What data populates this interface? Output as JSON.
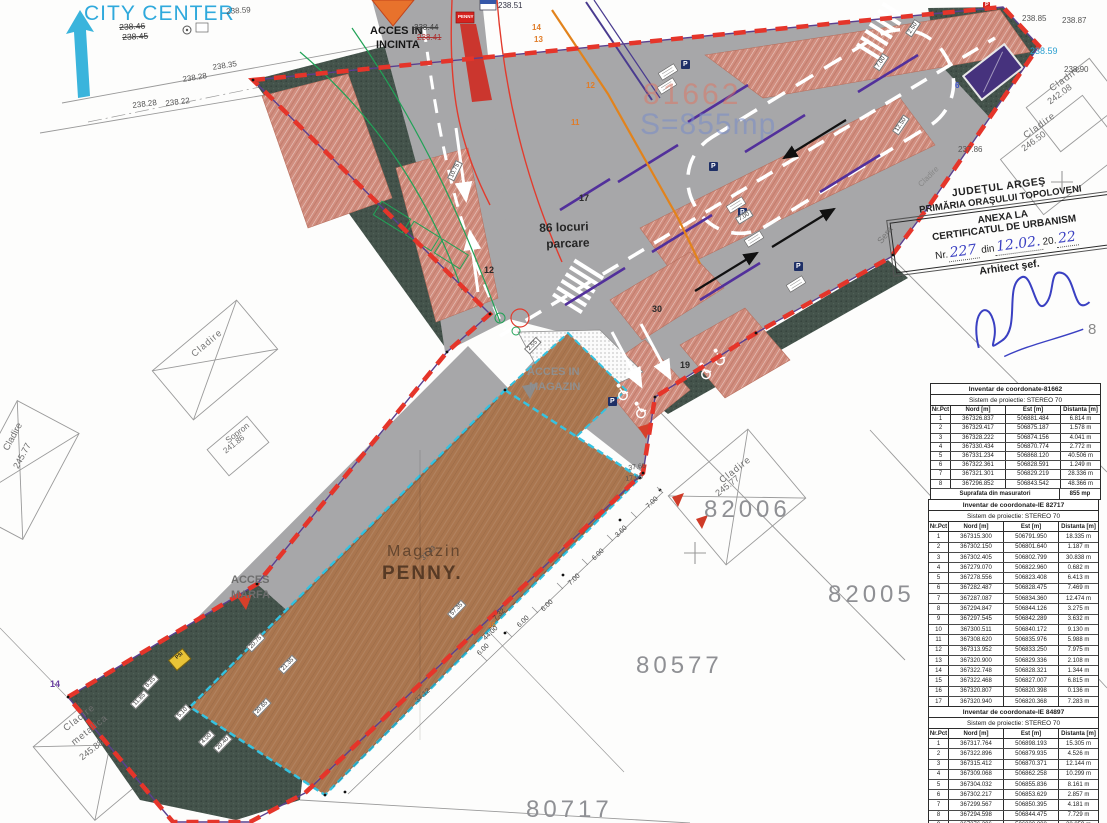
{
  "stamp": {
    "line1": "JUDEŢUL ARGEŞ",
    "line2": "PRIMĂRIA ORAŞULUI TOPOLOVENI",
    "line3": "ANEXA LA",
    "line4": "CERTIFICATUL DE URBANISM",
    "nr_label": "Nr.",
    "nr_value": "227",
    "din_label": "din",
    "date_value": "12.02.",
    "year_prefix": "20.",
    "year_value": "22",
    "line6": "Arhitect şef."
  },
  "tables": [
    {
      "title": "Inventar de coordonate-81662",
      "system": "Sistem de proiectie: STEREO 70",
      "columns": [
        "Nr.Pct",
        "Nord [m]",
        "Est [m]",
        "Distanta [m]"
      ],
      "row_h": 8.2,
      "rows": [
        [
          "1",
          "367326.837",
          "506881.484",
          "6.814 m"
        ],
        [
          "2",
          "367329.417",
          "506875.187",
          "1.578 m"
        ],
        [
          "3",
          "367328.222",
          "506874.156",
          "4.041 m"
        ],
        [
          "4",
          "367330.434",
          "506870.774",
          "2.772 m"
        ],
        [
          "5",
          "367331.234",
          "506868.120",
          "40.506 m"
        ],
        [
          "6",
          "367322.361",
          "506828.591",
          "1.249 m"
        ],
        [
          "7",
          "367321.301",
          "506829.219",
          "28.336 m"
        ],
        [
          "8",
          "367296.852",
          "506843.542",
          "48.366 m"
        ]
      ],
      "footer": [
        "Suprafata din masuratori",
        "855 mp"
      ]
    },
    {
      "title": "Inventar de coordonate-IE 82717",
      "system": "Sistem de proiectie: STEREO 70",
      "columns": [
        "Nr.Pct",
        "Nord [m]",
        "Est [m]",
        "Distanta [m]"
      ],
      "row_h": 9.3,
      "rows": [
        [
          "1",
          "367315.300",
          "506791.950",
          "18.335 m"
        ],
        [
          "2",
          "367302.150",
          "506801.640",
          "1.187 m"
        ],
        [
          "3",
          "367302.405",
          "506802.799",
          "30.838 m"
        ],
        [
          "4",
          "367279.070",
          "506822.960",
          "0.682 m"
        ],
        [
          "5",
          "367278.556",
          "506823.408",
          "6.413 m"
        ],
        [
          "6",
          "367282.487",
          "506828.475",
          "7.469 m"
        ],
        [
          "7",
          "367287.087",
          "506834.360",
          "12.474 m"
        ],
        [
          "8",
          "367294.847",
          "506844.126",
          "3.275 m"
        ],
        [
          "9",
          "367297.545",
          "506842.289",
          "3.632 m"
        ],
        [
          "10",
          "367300.511",
          "506840.172",
          "9.130 m"
        ],
        [
          "11",
          "367308.620",
          "506835.976",
          "5.988 m"
        ],
        [
          "12",
          "367313.952",
          "506833.250",
          "7.975 m"
        ],
        [
          "13",
          "367320.900",
          "506829.336",
          "2.108 m"
        ],
        [
          "14",
          "367322.748",
          "506828.321",
          "1.344 m"
        ],
        [
          "15",
          "367322.468",
          "506827.007",
          "6.815 m"
        ],
        [
          "16",
          "367320.807",
          "506820.398",
          "0.136 m"
        ],
        [
          "17",
          "367320.940",
          "506820.368",
          "7.283 m"
        ],
        [
          "18",
          "367319.542",
          "506813.220",
          "21.689 m"
        ]
      ],
      "footer": [
        "Suprafata din masuratori",
        "1205 mp"
      ]
    },
    {
      "title": "Inventar de coordonate-IE 84897",
      "system": "Sistem de proiectie: STEREO 70",
      "columns": [
        "Nr.Pct",
        "Nord [m]",
        "Est [m]",
        "Distanta [m]"
      ],
      "row_h": 9.2,
      "rows": [
        [
          "1",
          "367317.764",
          "506898.193",
          "15.305 m"
        ],
        [
          "2",
          "367322.896",
          "506879.935",
          "4.526 m"
        ],
        [
          "3",
          "367315.412",
          "506870.371",
          "12.144 m"
        ],
        [
          "4",
          "367309.068",
          "506862.258",
          "10.299 m"
        ],
        [
          "5",
          "367304.032",
          "506855.836",
          "8.161 m"
        ],
        [
          "6",
          "367302.217",
          "506853.629",
          "2.857 m"
        ],
        [
          "7",
          "367299.567",
          "506850.395",
          "4.181 m"
        ],
        [
          "8",
          "367294.598",
          "506844.475",
          "7.729 m"
        ],
        [
          "9",
          "367276.396",
          "506820.808",
          "28.859 m"
        ],
        [
          "10",
          "367260.303",
          "506801.685",
          "24.992 m"
        ]
      ],
      "footer": null
    }
  ],
  "floating_labels": [
    {
      "n": "city-center-label",
      "t": "CITY CENTER",
      "x": 84,
      "y": 3,
      "fs": 21,
      "c": "#2fa9dc",
      "ls": 1
    },
    {
      "n": "elev-238-59-top",
      "t": "238.59",
      "x": 226,
      "y": 8,
      "fs": 8,
      "c": "#555",
      "r": -4
    },
    {
      "n": "elev-238-46",
      "t": "238.46",
      "x": 119,
      "y": 23,
      "fs": 8.5,
      "c": "#3a3a3a",
      "r": -3,
      "strike": 1
    },
    {
      "n": "elev-238-45",
      "t": "238.45",
      "x": 122,
      "y": 33,
      "fs": 8.5,
      "c": "#3a3a3a",
      "r": -3,
      "strike": 1
    },
    {
      "n": "elev-238-35",
      "t": "238.35",
      "x": 212,
      "y": 64,
      "fs": 8,
      "c": "#555",
      "r": -9
    },
    {
      "n": "elev-238-28",
      "t": "238.28",
      "x": 182,
      "y": 76,
      "fs": 8,
      "c": "#555",
      "r": -9
    },
    {
      "n": "elev-238-28b",
      "t": "238.28",
      "x": 132,
      "y": 102,
      "fs": 8,
      "c": "#555",
      "r": -7
    },
    {
      "n": "elev-238-22",
      "t": "238.22",
      "x": 165,
      "y": 100,
      "fs": 8,
      "c": "#555",
      "r": -7
    },
    {
      "n": "acces-incinta-line1",
      "t": "ACCES IN",
      "x": 370,
      "y": 26,
      "fs": 11,
      "c": "#161616",
      "b": 1
    },
    {
      "n": "acces-incinta-line2",
      "t": "INCINTA",
      "x": 376,
      "y": 40,
      "fs": 11,
      "c": "#161616",
      "b": 1
    },
    {
      "n": "elev-238-44",
      "t": "238.44",
      "x": 414,
      "y": 24,
      "fs": 8,
      "c": "#444",
      "strike": 1
    },
    {
      "n": "elev-238-41",
      "t": "238.41",
      "x": 417,
      "y": 34,
      "fs": 8,
      "c": "#a33",
      "strike": 1
    },
    {
      "n": "elev-238-51",
      "t": "238.51",
      "x": 498,
      "y": 2,
      "fs": 8,
      "c": "#334"
    },
    {
      "n": "penny-totem-label",
      "t": "PENNY",
      "x": 458,
      "y": 15,
      "fs": 4.5,
      "c": "#fff",
      "b": 1
    },
    {
      "n": "pt-14",
      "t": "14",
      "x": 532,
      "y": 24,
      "fs": 8,
      "c": "#e07c28",
      "b": 1
    },
    {
      "n": "pt-13",
      "t": "13",
      "x": 534,
      "y": 36,
      "fs": 8,
      "c": "#e07c28",
      "b": 1
    },
    {
      "n": "pt-12",
      "t": "12",
      "x": 586,
      "y": 82,
      "fs": 8,
      "c": "#e07c28",
      "b": 1
    },
    {
      "n": "pt-11",
      "t": "11",
      "x": 571,
      "y": 119,
      "fs": 8,
      "c": "#e07c28",
      "b": 1
    },
    {
      "n": "pt-17",
      "t": "17",
      "x": 579,
      "y": 194,
      "fs": 9,
      "c": "#2b2b2b",
      "b": 1
    },
    {
      "n": "pt-12b",
      "t": "12",
      "x": 484,
      "y": 266,
      "fs": 9,
      "c": "#2b2b2b",
      "b": 1
    },
    {
      "n": "pt-30",
      "t": "30",
      "x": 652,
      "y": 305,
      "fs": 9,
      "c": "#2b2b2b",
      "b": 1
    },
    {
      "n": "pt-19",
      "t": "19",
      "x": 680,
      "y": 361,
      "fs": 9,
      "c": "#2b2b2b",
      "b": 1
    },
    {
      "n": "pt-16",
      "t": "16",
      "x": 488,
      "y": 622,
      "fs": 7,
      "c": "#e07c28",
      "b": 1
    },
    {
      "n": "pt-14-purple",
      "t": "14",
      "x": 50,
      "y": 680,
      "fs": 9,
      "c": "#6a3fa0",
      "b": 1
    },
    {
      "n": "pt-6-blue",
      "t": "6",
      "x": 955,
      "y": 82,
      "fs": 8,
      "c": "#3b52c8",
      "b": 1
    },
    {
      "n": "parcare-line1",
      "t": "86 locuri",
      "x": 539,
      "y": 222,
      "fs": 12,
      "c": "#262626",
      "b": 1,
      "r": -2
    },
    {
      "n": "parcare-line2",
      "t": "parcare",
      "x": 546,
      "y": 238,
      "fs": 12,
      "c": "#262626",
      "b": 1,
      "r": -2
    },
    {
      "n": "overlay-81662",
      "t": "81662",
      "x": 643,
      "y": 80,
      "fs": 30,
      "c": "rgba(225,115,95,0.5)",
      "ls": 3
    },
    {
      "n": "overlay-s855mp",
      "t": "S=855mp",
      "x": 640,
      "y": 110,
      "fs": 30,
      "c": "rgba(120,140,200,0.55)",
      "ls": 1
    },
    {
      "n": "acces-magazin-line1",
      "t": "ACCES IN",
      "x": 527,
      "y": 367,
      "fs": 11,
      "c": "#8f8f8f",
      "b": 1
    },
    {
      "n": "acces-magazin-line2",
      "t": "MAGAZIN",
      "x": 529,
      "y": 382,
      "fs": 11,
      "c": "#8f8f8f",
      "b": 1
    },
    {
      "n": "acces-marfa-line1",
      "t": "ACCES",
      "x": 231,
      "y": 575,
      "fs": 11,
      "c": "#6e6e6e",
      "b": 1
    },
    {
      "n": "acces-marfa-line2",
      "t": "MARFA",
      "x": 231,
      "y": 590,
      "fs": 11,
      "c": "#6e6e6e",
      "b": 1
    },
    {
      "n": "magazin-label",
      "t": "Magazin",
      "x": 387,
      "y": 544,
      "fs": 16,
      "c": "#64462f",
      "ls": 2
    },
    {
      "n": "penny-label",
      "t": "PENNY.",
      "x": 382,
      "y": 564,
      "fs": 19,
      "c": "#573a25",
      "b": 1,
      "ls": 2
    },
    {
      "n": "psi-label",
      "t": "PSI",
      "x": 175,
      "y": 657,
      "fs": 5,
      "c": "#222",
      "b": 1,
      "r": -40
    },
    {
      "n": "parcel-82006",
      "t": "82006",
      "x": 704,
      "y": 498,
      "fs": 24,
      "c": "#8f9094",
      "ls": 4
    },
    {
      "n": "parcel-82005",
      "t": "82005",
      "x": 828,
      "y": 583,
      "fs": 24,
      "c": "#8f9094",
      "ls": 4
    },
    {
      "n": "parcel-80577",
      "t": "80577",
      "x": 636,
      "y": 654,
      "fs": 24,
      "c": "#8f9094",
      "ls": 4
    },
    {
      "n": "parcel-80717",
      "t": "80717",
      "x": 526,
      "y": 798,
      "fs": 24,
      "c": "#8f9094",
      "ls": 4
    },
    {
      "n": "cladire-ne1-name",
      "t": "Cladire",
      "x": 1048,
      "y": 86,
      "fs": 9.5,
      "c": "#6f6f6f",
      "r": -36,
      "ls": 1
    },
    {
      "n": "cladire-ne1-elev",
      "t": "242.08",
      "x": 1046,
      "y": 99,
      "fs": 9,
      "c": "#6f6f6f",
      "r": -36
    },
    {
      "n": "cladire-ne2-name",
      "t": "Cladire",
      "x": 1022,
      "y": 133,
      "fs": 9.5,
      "c": "#6f6f6f",
      "r": -36,
      "ls": 1
    },
    {
      "n": "cladire-ne2-elev",
      "t": "246.50",
      "x": 1020,
      "y": 146,
      "fs": 9,
      "c": "#6f6f6f",
      "r": -36
    },
    {
      "n": "elev-238-85",
      "t": "238.85",
      "x": 1022,
      "y": 15,
      "fs": 8,
      "c": "#555"
    },
    {
      "n": "elev-238-87",
      "t": "238.87",
      "x": 1062,
      "y": 17,
      "fs": 8,
      "c": "#555"
    },
    {
      "n": "elev-238-59-right",
      "t": "238.59",
      "x": 1030,
      "y": 47,
      "fs": 9,
      "c": "#2a9fd0"
    },
    {
      "n": "elev-238-90",
      "t": "238.90",
      "x": 1064,
      "y": 66,
      "fs": 8,
      "c": "#555"
    },
    {
      "n": "elev-237-86",
      "t": "237.86",
      "x": 958,
      "y": 146,
      "fs": 8,
      "c": "#555"
    },
    {
      "n": "cladire-82006-name",
      "t": "Cladire",
      "x": 718,
      "y": 478,
      "fs": 9.5,
      "c": "#6f6f6f",
      "r": -38,
      "ls": 1
    },
    {
      "n": "cladire-82006-elev",
      "t": "245.77",
      "x": 714,
      "y": 491,
      "fs": 9,
      "c": "#6f6f6f",
      "r": -38
    },
    {
      "n": "sopron-name",
      "t": "Sopron",
      "x": 224,
      "y": 438,
      "fs": 8.5,
      "c": "#6f6f6f",
      "r": -38
    },
    {
      "n": "sopron-elev",
      "t": "241.86",
      "x": 222,
      "y": 449,
      "fs": 8,
      "c": "#6f6f6f",
      "r": -38
    },
    {
      "n": "cladire-left-name",
      "t": "Cladire",
      "x": 2,
      "y": 448,
      "fs": 9.5,
      "c": "#6f6f6f",
      "r": -62
    },
    {
      "n": "cladire-left-elev",
      "t": "245.77",
      "x": 12,
      "y": 466,
      "fs": 9,
      "c": "#6f6f6f",
      "r": -62
    },
    {
      "n": "cladire-west-name",
      "t": "Cladire",
      "x": 190,
      "y": 352,
      "fs": 9.5,
      "c": "#777777",
      "r": -40,
      "ls": 1
    },
    {
      "n": "cladire-metalica-1",
      "t": "Cladire",
      "x": 62,
      "y": 726,
      "fs": 9.5,
      "c": "#6f6f6f",
      "r": -38,
      "ls": 1
    },
    {
      "n": "cladire-metalica-2",
      "t": "metalica",
      "x": 70,
      "y": 740,
      "fs": 9.5,
      "c": "#6f6f6f",
      "r": -38,
      "ls": 1
    },
    {
      "n": "cladire-metalica-3",
      "t": "245.88",
      "x": 78,
      "y": 755,
      "fs": 9,
      "c": "#6f6f6f",
      "r": -38
    },
    {
      "n": "sera-label",
      "t": "Sera",
      "x": 876,
      "y": 240,
      "fs": 9,
      "c": "#777777",
      "r": -52
    },
    {
      "n": "cladire-stamp",
      "t": "Cladire",
      "x": 917,
      "y": 183,
      "fs": 8,
      "c": "#888888",
      "r": -45
    },
    {
      "n": "big-8",
      "t": "8",
      "x": 1088,
      "y": 322,
      "fs": 15,
      "c": "#8a8a8a"
    },
    {
      "n": "p-sign-label-1",
      "t": "P",
      "x": 683,
      "y": 61,
      "fs": 7,
      "c": "#fff",
      "b": 1
    },
    {
      "n": "p-sign-label-2",
      "t": "P",
      "x": 711,
      "y": 163,
      "fs": 7,
      "c": "#fff",
      "b": 1
    },
    {
      "n": "p-sign-label-3",
      "t": "P",
      "x": 740,
      "y": 209,
      "fs": 7,
      "c": "#fff",
      "b": 1
    },
    {
      "n": "p-sign-label-4",
      "t": "P",
      "x": 796,
      "y": 263,
      "fs": 7,
      "c": "#fff",
      "b": 1
    },
    {
      "n": "p-sign-label-5",
      "t": "P",
      "x": 610,
      "y": 398,
      "fs": 7,
      "c": "#fff",
      "b": 1
    },
    {
      "n": "p-sign-label-6",
      "t": "P",
      "x": 985,
      "y": 3,
      "fs": 5.5,
      "c": "#fff",
      "b": 1
    },
    {
      "n": "dim-10-75",
      "t": "10.75",
      "x": 447,
      "y": 178,
      "fs": 6,
      "r": -64,
      "w": 1
    },
    {
      "n": "dim-2-50",
      "t": "2.50",
      "x": 905,
      "y": 33,
      "fs": 6,
      "r": -56,
      "w": 1
    },
    {
      "n": "dim-7-00a",
      "t": "7.00",
      "x": 873,
      "y": 67,
      "fs": 6,
      "r": -56,
      "w": 1
    },
    {
      "n": "dim-12-50",
      "t": "12.50",
      "x": 892,
      "y": 131,
      "fs": 6,
      "r": -56,
      "w": 1
    },
    {
      "n": "dim-7-00b",
      "t": "7.00",
      "x": 735,
      "y": 218,
      "fs": 6,
      "r": -32,
      "w": 1
    },
    {
      "n": "dim-2-55",
      "t": "2.55",
      "x": 524,
      "y": 349,
      "fs": 6,
      "r": -46,
      "w": 1
    },
    {
      "n": "dim-20-75",
      "t": "20.75",
      "x": 246,
      "y": 647,
      "fs": 6,
      "r": -46,
      "w": 1
    },
    {
      "n": "dim-8-35",
      "t": "8.35",
      "x": 142,
      "y": 686,
      "fs": 6,
      "r": -46,
      "w": 1
    },
    {
      "n": "dim-11-85",
      "t": "11.85",
      "x": 130,
      "y": 704,
      "fs": 6,
      "r": -46,
      "w": 1
    },
    {
      "n": "dim-5-10",
      "t": "5.10",
      "x": 174,
      "y": 716,
      "fs": 6,
      "r": -46,
      "w": 1
    },
    {
      "n": "dim-4-00",
      "t": "4.00",
      "x": 198,
      "y": 742,
      "fs": 6,
      "r": -46,
      "w": 1
    },
    {
      "n": "dim-20-40",
      "t": "20.40",
      "x": 213,
      "y": 748,
      "fs": 6,
      "r": -46,
      "w": 1
    },
    {
      "n": "dim-20-65",
      "t": "20.65",
      "x": 252,
      "y": 712,
      "fs": 6,
      "r": -46,
      "w": 1
    },
    {
      "n": "dim-21-35",
      "t": "21.35",
      "x": 278,
      "y": 669,
      "fs": 6,
      "r": -46,
      "w": 1
    },
    {
      "n": "dim-57-35",
      "t": "57.35",
      "x": 447,
      "y": 614,
      "fs": 6,
      "r": -46,
      "w": 1
    },
    {
      "n": "dim-37-43",
      "t": "37.43",
      "x": 420,
      "y": 557,
      "fs": 7,
      "c": "#555",
      "r": -44
    },
    {
      "n": "dim-37-12",
      "t": "37.12",
      "x": 414,
      "y": 699,
      "fs": 7,
      "c": "#555",
      "r": -42
    },
    {
      "n": "dim-37-66",
      "t": "37.66",
      "x": 628,
      "y": 465,
      "fs": 7,
      "c": "#555",
      "r": -8
    },
    {
      "n": "dim-17-66",
      "t": "17.66",
      "x": 625,
      "y": 476,
      "fs": 7,
      "c": "#555",
      "r": -8
    },
    {
      "n": "dim-7-00c",
      "t": "7.00",
      "x": 645,
      "y": 505,
      "fs": 7,
      "c": "#444",
      "r": -44
    },
    {
      "n": "dim-3-60",
      "t": "3.60",
      "x": 614,
      "y": 534,
      "fs": 7,
      "c": "#444",
      "r": -44
    },
    {
      "n": "dim-6-00a",
      "t": "6.00",
      "x": 591,
      "y": 557,
      "fs": 7,
      "c": "#444",
      "r": -44
    },
    {
      "n": "dim-7-00d",
      "t": "7.00",
      "x": 567,
      "y": 582,
      "fs": 7,
      "c": "#444",
      "r": -44
    },
    {
      "n": "dim-6-00b",
      "t": "6.00",
      "x": 540,
      "y": 608,
      "fs": 7,
      "c": "#444",
      "r": -44
    },
    {
      "n": "dim-7-32",
      "t": "7.32",
      "x": 492,
      "y": 617,
      "fs": 7,
      "c": "#444",
      "r": -44
    },
    {
      "n": "dim-6-00c",
      "t": "6.00",
      "x": 516,
      "y": 624,
      "fs": 7,
      "c": "#444",
      "r": -44
    },
    {
      "n": "dim-44-00",
      "t": "44.00",
      "x": 482,
      "y": 637,
      "fs": 7,
      "c": "#444",
      "r": -44
    },
    {
      "n": "dim-6-00d",
      "t": "6.00",
      "x": 476,
      "y": 652,
      "fs": 7,
      "c": "#444",
      "r": -44
    }
  ],
  "colors": {
    "boundary_red": "#e5352a",
    "cadastral_purple": "#5a3f8f",
    "road_gray": "#a7a7a9",
    "green_area": "#44534b",
    "parking_salmon": "#d18d7e",
    "building_brown": "#aa764f",
    "building_outline_cyan": "#35c2e0",
    "city_center_cyan": "#2fa9dc",
    "handwriting_blue": "#3a40c2",
    "orange_line": "#e2831c"
  }
}
